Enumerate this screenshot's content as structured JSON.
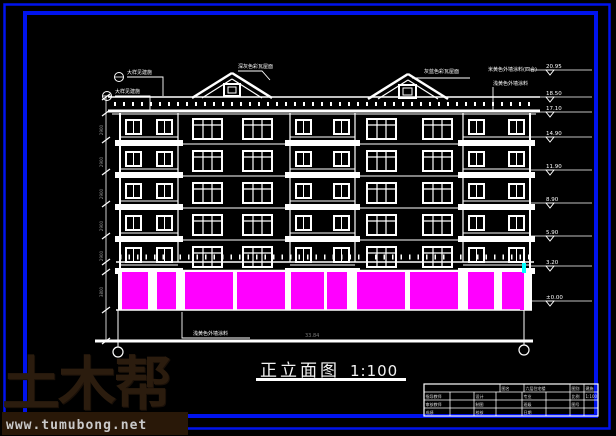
{
  "title": {
    "text": "正立面图",
    "scale": "1:100"
  },
  "watermark": {
    "brand": "土木帮",
    "url": "www.tumubong.net"
  },
  "bottom_dimension": "33.84",
  "colors": {
    "frame_blue": "#0013ee",
    "line_white": "#ffffff",
    "storefront_magenta": "#ff00ff",
    "accent_cyan": "#00ffff",
    "dim_gray": "#9a9a9a",
    "watermark_brown": "#2b1c0e"
  },
  "annotations": [
    {
      "text": "大样见建施",
      "x": 127,
      "y": 74,
      "leader": [
        [
          127,
          77
        ],
        [
          163,
          77
        ],
        [
          163,
          96
        ]
      ],
      "bubble": [
        119,
        77
      ]
    },
    {
      "text": "大样见建施",
      "x": 115,
      "y": 93,
      "leader": [
        [
          115,
          96
        ],
        [
          150,
          96
        ],
        [
          150,
          112
        ]
      ],
      "bubble": [
        107,
        96
      ]
    },
    {
      "text": "深灰色彩瓦屋面",
      "x": 238,
      "y": 68,
      "leader": [
        [
          238,
          71
        ],
        [
          262,
          71
        ],
        [
          270,
          80
        ]
      ]
    },
    {
      "text": "灰蓝色彩瓦屋面",
      "x": 424,
      "y": 73,
      "leader": [
        [
          470,
          78
        ],
        [
          412,
          78
        ]
      ]
    },
    {
      "text": "米黄色外墙涂料(四合)",
      "x": 488,
      "y": 71,
      "leader": []
    },
    {
      "text": "浅黄色外墙涂料",
      "x": 493,
      "y": 85,
      "leader": [
        [
          493,
          87
        ],
        [
          493,
          112
        ]
      ]
    },
    {
      "text": "浅黄色外墙涂料",
      "x": 193,
      "y": 335,
      "leader": [
        [
          182,
          312
        ],
        [
          182,
          338
        ],
        [
          250,
          338
        ]
      ]
    }
  ],
  "elevation_markers": [
    {
      "y": 70,
      "value": "20.95"
    },
    {
      "y": 97,
      "value": "18.50"
    },
    {
      "y": 112,
      "value": "17.10"
    },
    {
      "y": 137,
      "value": "14.90"
    },
    {
      "y": 170,
      "value": "11.90"
    },
    {
      "y": 203,
      "value": "8.90"
    },
    {
      "y": 236,
      "value": "5.90"
    },
    {
      "y": 266,
      "value": "3.20"
    },
    {
      "y": 301,
      "value": "±0.00"
    }
  ],
  "left_dimensions": [
    {
      "y": 130,
      "value": "2900"
    },
    {
      "y": 162,
      "value": "2900"
    },
    {
      "y": 194,
      "value": "2900"
    },
    {
      "y": 226,
      "value": "2900"
    },
    {
      "y": 256,
      "value": "2900"
    },
    {
      "y": 292,
      "value": "3800"
    }
  ],
  "title_block": {
    "cells": [
      {
        "x": 424,
        "y": 384,
        "w": 76,
        "h": 8,
        "t": ""
      },
      {
        "x": 500,
        "y": 384,
        "w": 24,
        "h": 8,
        "t": "图名"
      },
      {
        "x": 524,
        "y": 384,
        "w": 46,
        "h": 8,
        "t": "六层住宅楼"
      },
      {
        "x": 570,
        "y": 384,
        "w": 14,
        "h": 8,
        "t": "图别"
      },
      {
        "x": 584,
        "y": 384,
        "w": 14,
        "h": 8,
        "t": "建施"
      },
      {
        "x": 424,
        "y": 392,
        "w": 26,
        "h": 8,
        "t": "指导教师"
      },
      {
        "x": 450,
        "y": 392,
        "w": 24,
        "h": 8,
        "t": ""
      },
      {
        "x": 474,
        "y": 392,
        "w": 22,
        "h": 8,
        "t": "设计"
      },
      {
        "x": 496,
        "y": 392,
        "w": 26,
        "h": 8,
        "t": ""
      },
      {
        "x": 522,
        "y": 392,
        "w": 24,
        "h": 8,
        "t": "专业"
      },
      {
        "x": 546,
        "y": 392,
        "w": 24,
        "h": 8,
        "t": ""
      },
      {
        "x": 570,
        "y": 392,
        "w": 14,
        "h": 8,
        "t": "比例"
      },
      {
        "x": 584,
        "y": 392,
        "w": 14,
        "h": 8,
        "t": "1:100"
      },
      {
        "x": 424,
        "y": 400,
        "w": 26,
        "h": 8,
        "t": "审核教师"
      },
      {
        "x": 450,
        "y": 400,
        "w": 24,
        "h": 8,
        "t": ""
      },
      {
        "x": 474,
        "y": 400,
        "w": 22,
        "h": 8,
        "t": "制图"
      },
      {
        "x": 496,
        "y": 400,
        "w": 26,
        "h": 8,
        "t": ""
      },
      {
        "x": 522,
        "y": 400,
        "w": 24,
        "h": 8,
        "t": "班级"
      },
      {
        "x": 546,
        "y": 400,
        "w": 24,
        "h": 8,
        "t": ""
      },
      {
        "x": 570,
        "y": 400,
        "w": 14,
        "h": 8,
        "t": "图号"
      },
      {
        "x": 584,
        "y": 400,
        "w": 14,
        "h": 8,
        "t": ""
      },
      {
        "x": 424,
        "y": 408,
        "w": 26,
        "h": 8,
        "t": "成绩"
      },
      {
        "x": 450,
        "y": 408,
        "w": 24,
        "h": 8,
        "t": ""
      },
      {
        "x": 474,
        "y": 408,
        "w": 22,
        "h": 8,
        "t": "校核"
      },
      {
        "x": 496,
        "y": 408,
        "w": 26,
        "h": 8,
        "t": ""
      },
      {
        "x": 522,
        "y": 408,
        "w": 24,
        "h": 8,
        "t": "日期"
      },
      {
        "x": 546,
        "y": 408,
        "w": 24,
        "h": 8,
        "t": ""
      },
      {
        "x": 570,
        "y": 408,
        "w": 14,
        "h": 8,
        "t": ""
      },
      {
        "x": 584,
        "y": 408,
        "w": 14,
        "h": 8,
        "t": ""
      }
    ]
  },
  "figure": {
    "building": {
      "left": 120,
      "right": 530,
      "top": 113,
      "groundY": 310
    },
    "eave": {
      "x1": 108,
      "x2": 540,
      "yTop": 97,
      "yBot": 111
    },
    "gables": [
      {
        "peak": [
          232,
          73
        ],
        "b1": 192,
        "b2": 272,
        "eaveY": 98,
        "win": [
          224,
          84,
          16,
          12
        ]
      },
      {
        "peak": [
          408,
          74
        ],
        "b1": 368,
        "b2": 448,
        "eaveY": 99,
        "win": [
          399,
          85,
          17,
          13
        ]
      }
    ],
    "floor_rows": [
      118,
      150,
      182,
      214,
      246
    ],
    "balcony_bays": [
      [
        120,
        58
      ],
      [
        290,
        65
      ],
      [
        463,
        67
      ]
    ],
    "wall_windows": [
      193,
      243,
      367,
      423
    ],
    "wall_window_w": 29,
    "awning": {
      "yTop": 262,
      "yBot": 271,
      "tickY": 257
    },
    "panels": {
      "y": 272,
      "h": 38,
      "items": [
        [
          122,
          26
        ],
        [
          157,
          19
        ],
        [
          185,
          48
        ],
        [
          237,
          48
        ],
        [
          291,
          33
        ],
        [
          327,
          20
        ],
        [
          357,
          48
        ],
        [
          410,
          48
        ],
        [
          468,
          26
        ],
        [
          502,
          22
        ]
      ]
    },
    "heavy_line": {
      "y": 341,
      "x1": 95,
      "x2": 533
    },
    "axes": [
      {
        "x": 118,
        "cy": 352
      },
      {
        "x": 524,
        "cy": 350
      }
    ],
    "accents": {
      "cyan": [
        522,
        263,
        4,
        10
      ],
      "magenta": [
        520,
        277,
        4,
        33
      ]
    }
  }
}
